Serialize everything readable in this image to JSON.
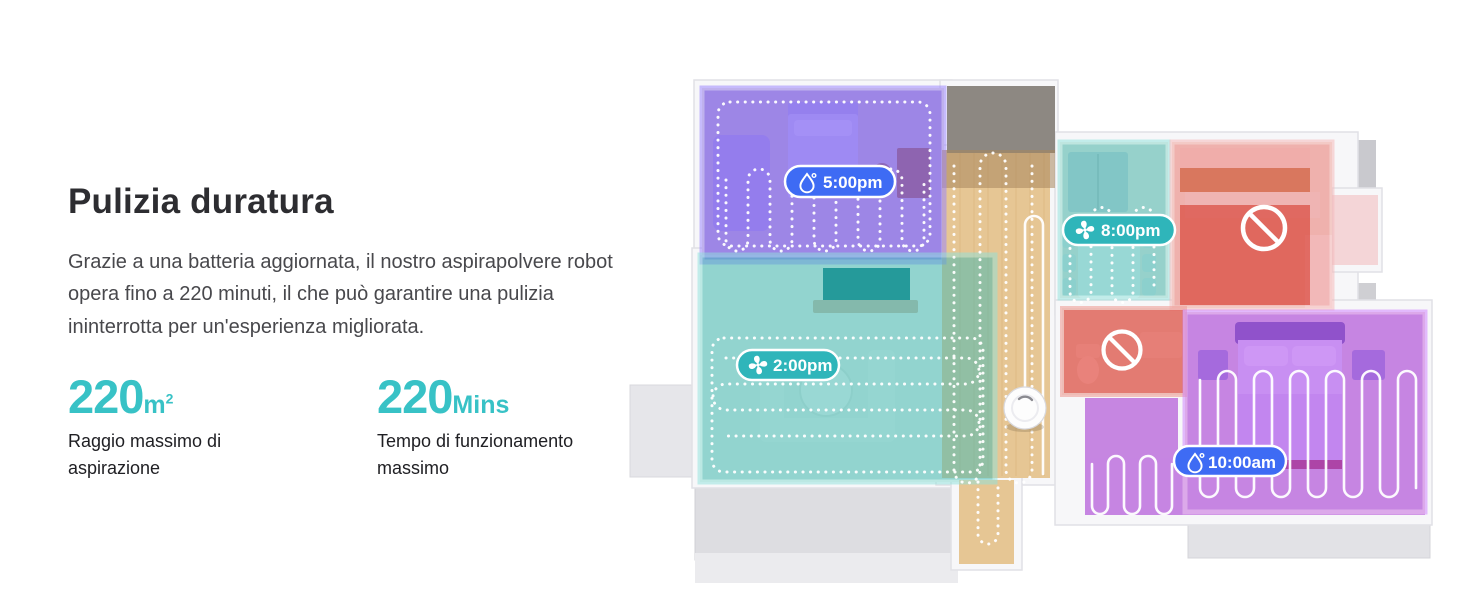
{
  "left_panel": {
    "title": "Pulizia duratura",
    "description": "Grazie a una batteria aggiornata, il nostro aspirapolvere robot opera fino a 220 minuti, il che può garantire una pulizia ininterrotta per un'esperienza migliorata.",
    "stats": [
      {
        "value": "220",
        "unit": "m",
        "unit_sup": "2",
        "label": "Raggio massimo di aspirazione"
      },
      {
        "value": "220",
        "unit": "Mins",
        "unit_sup": "",
        "label": "Tempo di funzionamento massimo"
      }
    ]
  },
  "floorplan": {
    "badges": [
      {
        "id": "room-top-left",
        "time": "5:00pm",
        "icon": "water-drop-icon",
        "color": "#3e6bf4"
      },
      {
        "id": "room-dining",
        "time": "8:00pm",
        "icon": "fan-icon",
        "color": "#2fb5ba"
      },
      {
        "id": "room-living",
        "time": "2:00pm",
        "icon": "fan-icon",
        "color": "#2fb5ba"
      },
      {
        "id": "room-bedroom",
        "time": "10:00am",
        "icon": "water-drop-icon",
        "color": "#3e6bf4"
      }
    ],
    "no_entry_sign_count": 2
  },
  "colors": {
    "accent_teal": "#38c2c6",
    "badge_blue": "#3e6bf4",
    "badge_teal": "#2fb5ba",
    "room_overlay_blue": "#5a36f2",
    "room_overlay_teal": "#3fbab4",
    "room_overlay_red": "#de3428",
    "room_overlay_pink": "#ef8f8f",
    "room_overlay_purple": "#a336ee",
    "title_text": "#2d2d31",
    "body_text": "#48484c"
  }
}
